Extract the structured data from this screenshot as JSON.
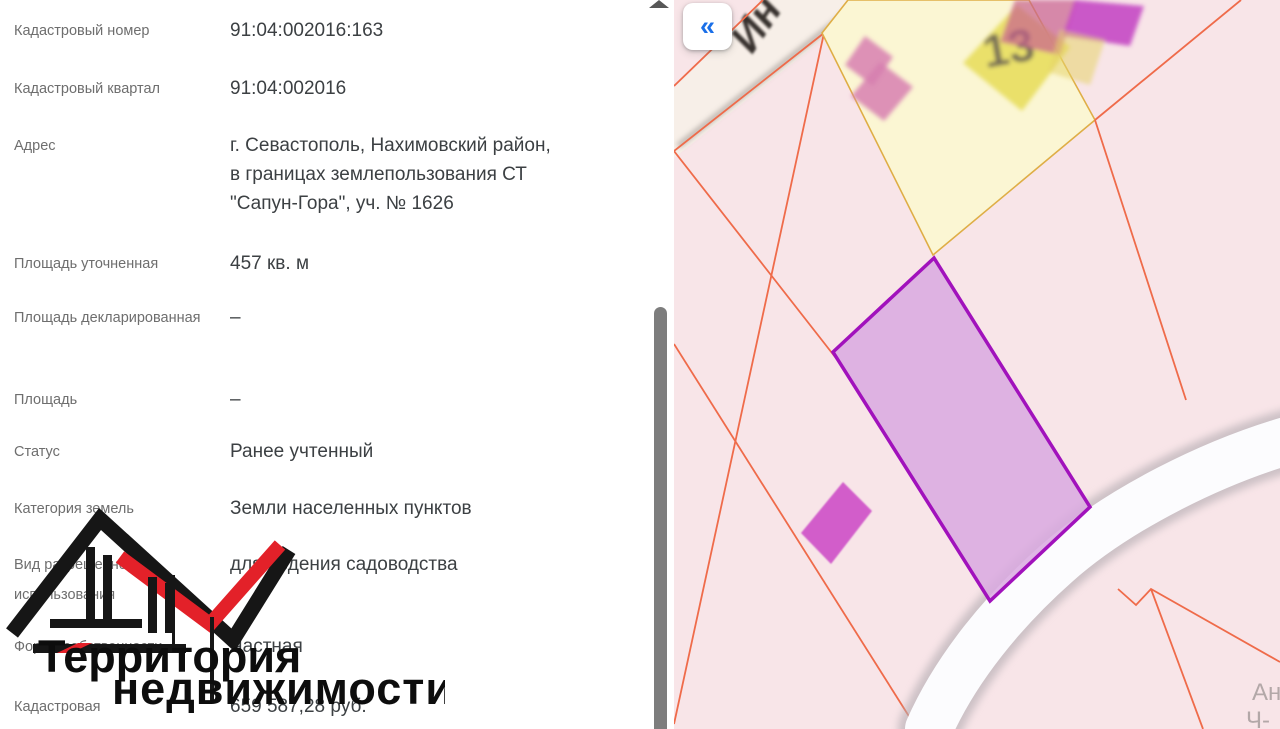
{
  "panel": {
    "fields": [
      {
        "label": "Кадастровый номер",
        "value": "91:04:002016:163"
      },
      {
        "label": "Кадастровый квартал",
        "value": "91:04:002016"
      },
      {
        "label": "Адрес",
        "value": "г. Севастополь, Нахимовский район,\nв границах землепользования СТ\n\"Сапун-Гора\", уч. № 1626"
      },
      {
        "label": "Площадь уточненная",
        "value": "457 кв. м"
      },
      {
        "label": "Площадь декларированная",
        "value": "–"
      },
      {
        "label": "Площадь",
        "value": "–"
      },
      {
        "label": "Статус",
        "value": "Ранее учтенный"
      },
      {
        "label": "Категория земель",
        "value": "Земли населенных пунктов"
      },
      {
        "label": "Вид разрешенного использования",
        "value": "для ведения садоводства"
      },
      {
        "label": "Форма собственности",
        "value": "Частная"
      },
      {
        "label": "Кадастровая",
        "value": "659 587,28 руб."
      }
    ]
  },
  "watermark": {
    "line1": "Территория",
    "line2": "недвижимости",
    "logo_black": "#161616",
    "logo_red": "#e32129"
  },
  "map": {
    "collapse_button": "«",
    "street_label": "Ин",
    "parcel_label": "13",
    "corner_label_line1": "Ан",
    "corner_label_line2": "Ч-",
    "colors": {
      "accent_blue": "#1a6fe8",
      "background_pink": "#f8e5e8",
      "parcel_line_orange": "#ef6b4a",
      "yellow_parcel_fill": "#fbf6d3",
      "yellow_parcel_border": "#dfae46",
      "selected_parcel_border": "#a112bc",
      "selected_parcel_fill": "#d9a9e0",
      "building_magenta": "#c23ec2",
      "building_pink": "#d77fb0",
      "building_yellow": "#e8de62",
      "road_white": "#fcfcfe"
    }
  }
}
